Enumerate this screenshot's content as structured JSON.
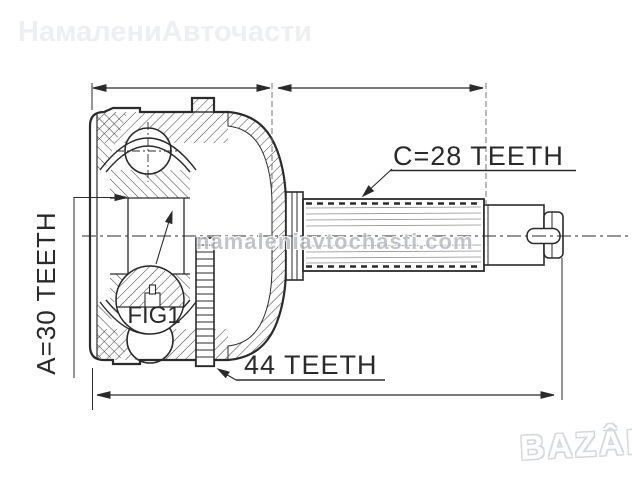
{
  "watermarks": {
    "top_left": "НамалениАвточасти",
    "center": "namaleniavtochasti.com",
    "logo": "BAZÂR"
  },
  "callouts": {
    "shaft_spline": "C=28 TEETH",
    "inner_spline": "A=30 TEETH",
    "abs_ring": "44 TEETH",
    "detail": "FIG1"
  },
  "colors": {
    "background": "#ffffff",
    "line": "#2b2b2b",
    "watermark_light": "#edeff2",
    "watermark_gray": "#b7bbc2",
    "logo_outline": "#d6d9dc"
  }
}
